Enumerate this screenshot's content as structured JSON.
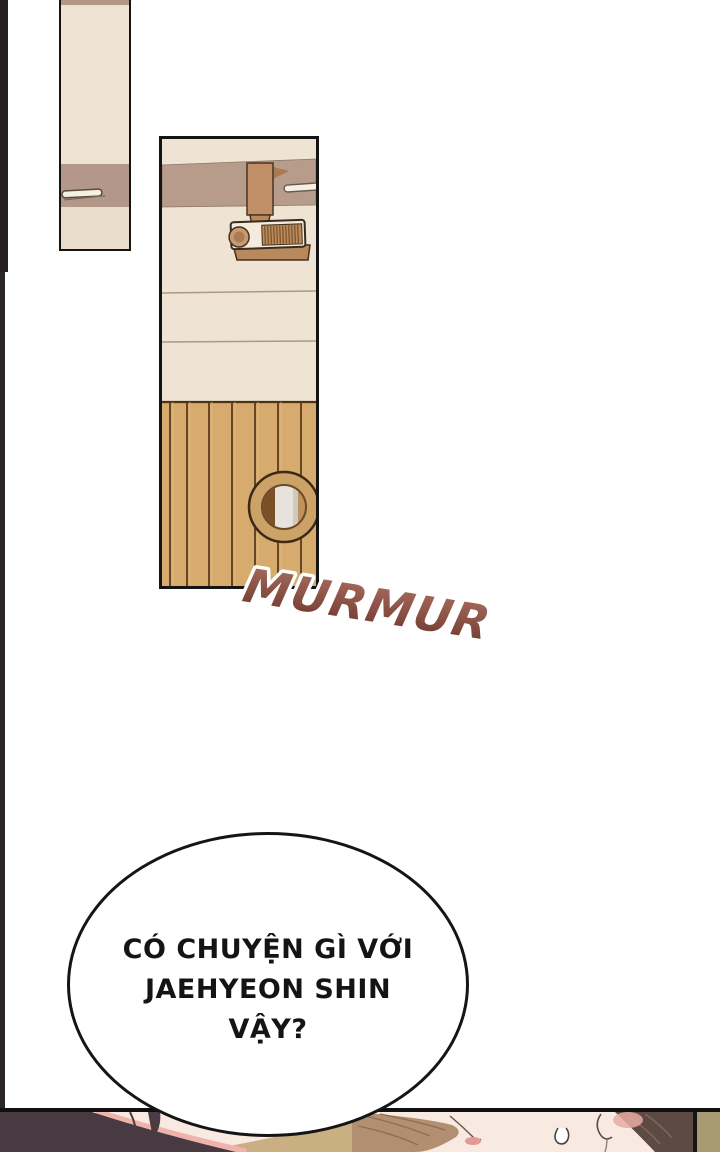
{
  "scene": {
    "type": "webtoon-comic-page",
    "background_color": "#ffffff",
    "panel_count": 3
  },
  "sfx": {
    "murmur_text": "MURMUR",
    "murmur_gradient_top": "#a86e60",
    "murmur_gradient_bottom": "#6e362c",
    "murmur_outline_color": "#ffffff"
  },
  "speech_bubble": {
    "line1": "CÓ CHUYỆN GÌ VỚI",
    "line2": "JAEHYEON SHIN",
    "line3": "VẬY?",
    "text_color": "#141414",
    "fill_color": "#ffffff",
    "outline_color": "#151515"
  },
  "palette": {
    "wall_cream": "#efe4d4",
    "wall_band_taupe": "#b79c8b",
    "wood_slats": "#d6ab6d",
    "wood_line": "#5c3a1c",
    "projector_brown": "#c08f68",
    "ring_tan": "#cda267",
    "towel_gray": "#e7e2db",
    "left_hair_dark": "#483a40",
    "hair_rim_pink": "#eeb3ab",
    "khaki_shoulder": "#c9af82",
    "wavy_hair_brown": "#b18f70",
    "right_hair_brown": "#5d4a42",
    "right_wall_khaki": "#a89a73",
    "skin": "#f8e9e1",
    "edge_strip": "#242021"
  }
}
